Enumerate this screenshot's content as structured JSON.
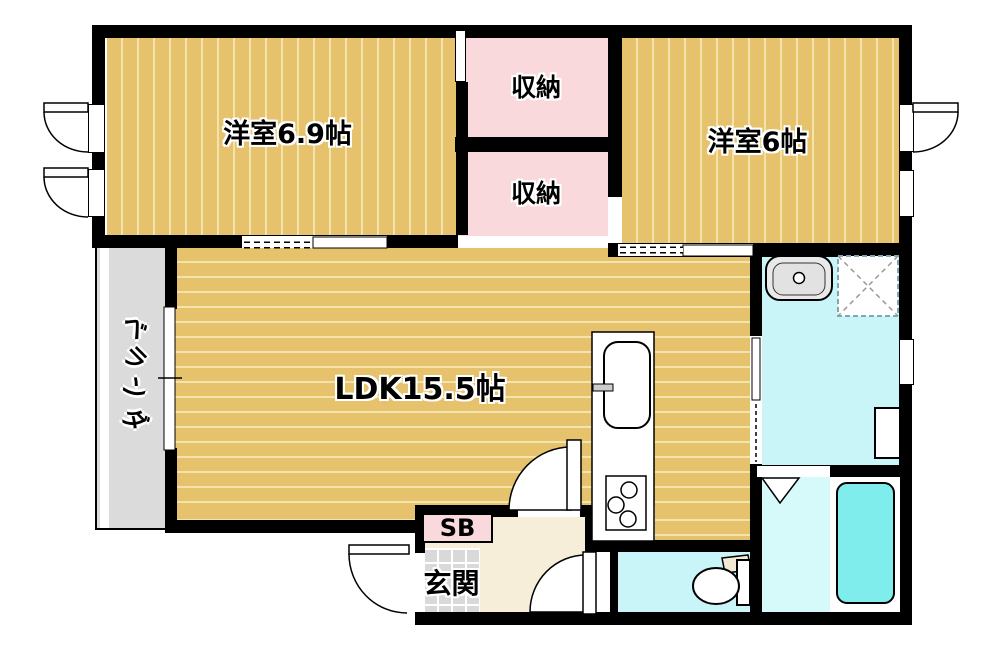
{
  "plan_title": "2LDK apartment floor plan",
  "rooms": {
    "bedroom1": {
      "label": "洋室6.9帖"
    },
    "closet1": {
      "label": "収納"
    },
    "closet2": {
      "label": "収納"
    },
    "bedroom2": {
      "label": "洋室6帖"
    },
    "ldk": {
      "label": "LDK15.5帖"
    },
    "veranda": {
      "label": "ベランダ"
    },
    "genkan": {
      "label": "玄関"
    },
    "shoebox": {
      "label": "SB"
    }
  },
  "fixtures": [
    "kitchen-sink",
    "gas-stove",
    "wash-basin",
    "washing-machine-pan",
    "bathtub",
    "toilet",
    "entrance-door",
    "ldk-door",
    "toilet-door",
    "bath-folding-door",
    "casement-window",
    "sliding-window",
    "sliding-partition"
  ],
  "colors": {
    "wall": "#000000",
    "wood_floor": "#e5c26b",
    "wood_stripe": "#f3e3ac",
    "closet_pink": "#fad9dd",
    "water_cyan": "#c9f4f8",
    "bathtub_cyan": "#7fedeb",
    "veranda_gray": "#dbdbdb",
    "tile_gray": "#d9d9d9",
    "hall_cream": "#f6eed8"
  }
}
